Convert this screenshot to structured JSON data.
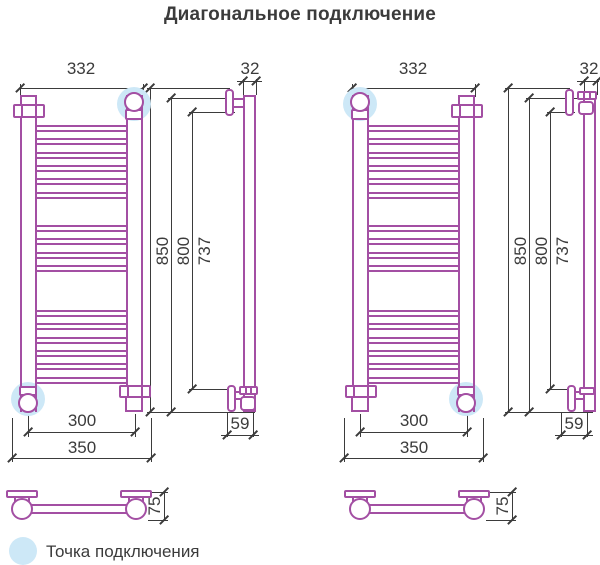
{
  "title": "Диагональное подключение",
  "legend": {
    "label": "Точка подключения"
  },
  "dims": {
    "top_width": "332",
    "tube_diameter": "32",
    "height_total": "850",
    "height_tube": "800",
    "height_mount": "737",
    "bottom_axes": "300",
    "bottom_total": "350",
    "wall_offset": "59",
    "depth": "75"
  },
  "colors": {
    "outline": "#A34FA3",
    "ink": "#3B3B3B",
    "highlight": "#CDE8F7"
  },
  "rungs": {
    "pitch": 13.3,
    "height": 7,
    "groups": [
      {
        "count": 6,
        "start": 0
      },
      {
        "count": 4,
        "start": 100
      },
      {
        "count": 6,
        "start": 185
      }
    ]
  }
}
